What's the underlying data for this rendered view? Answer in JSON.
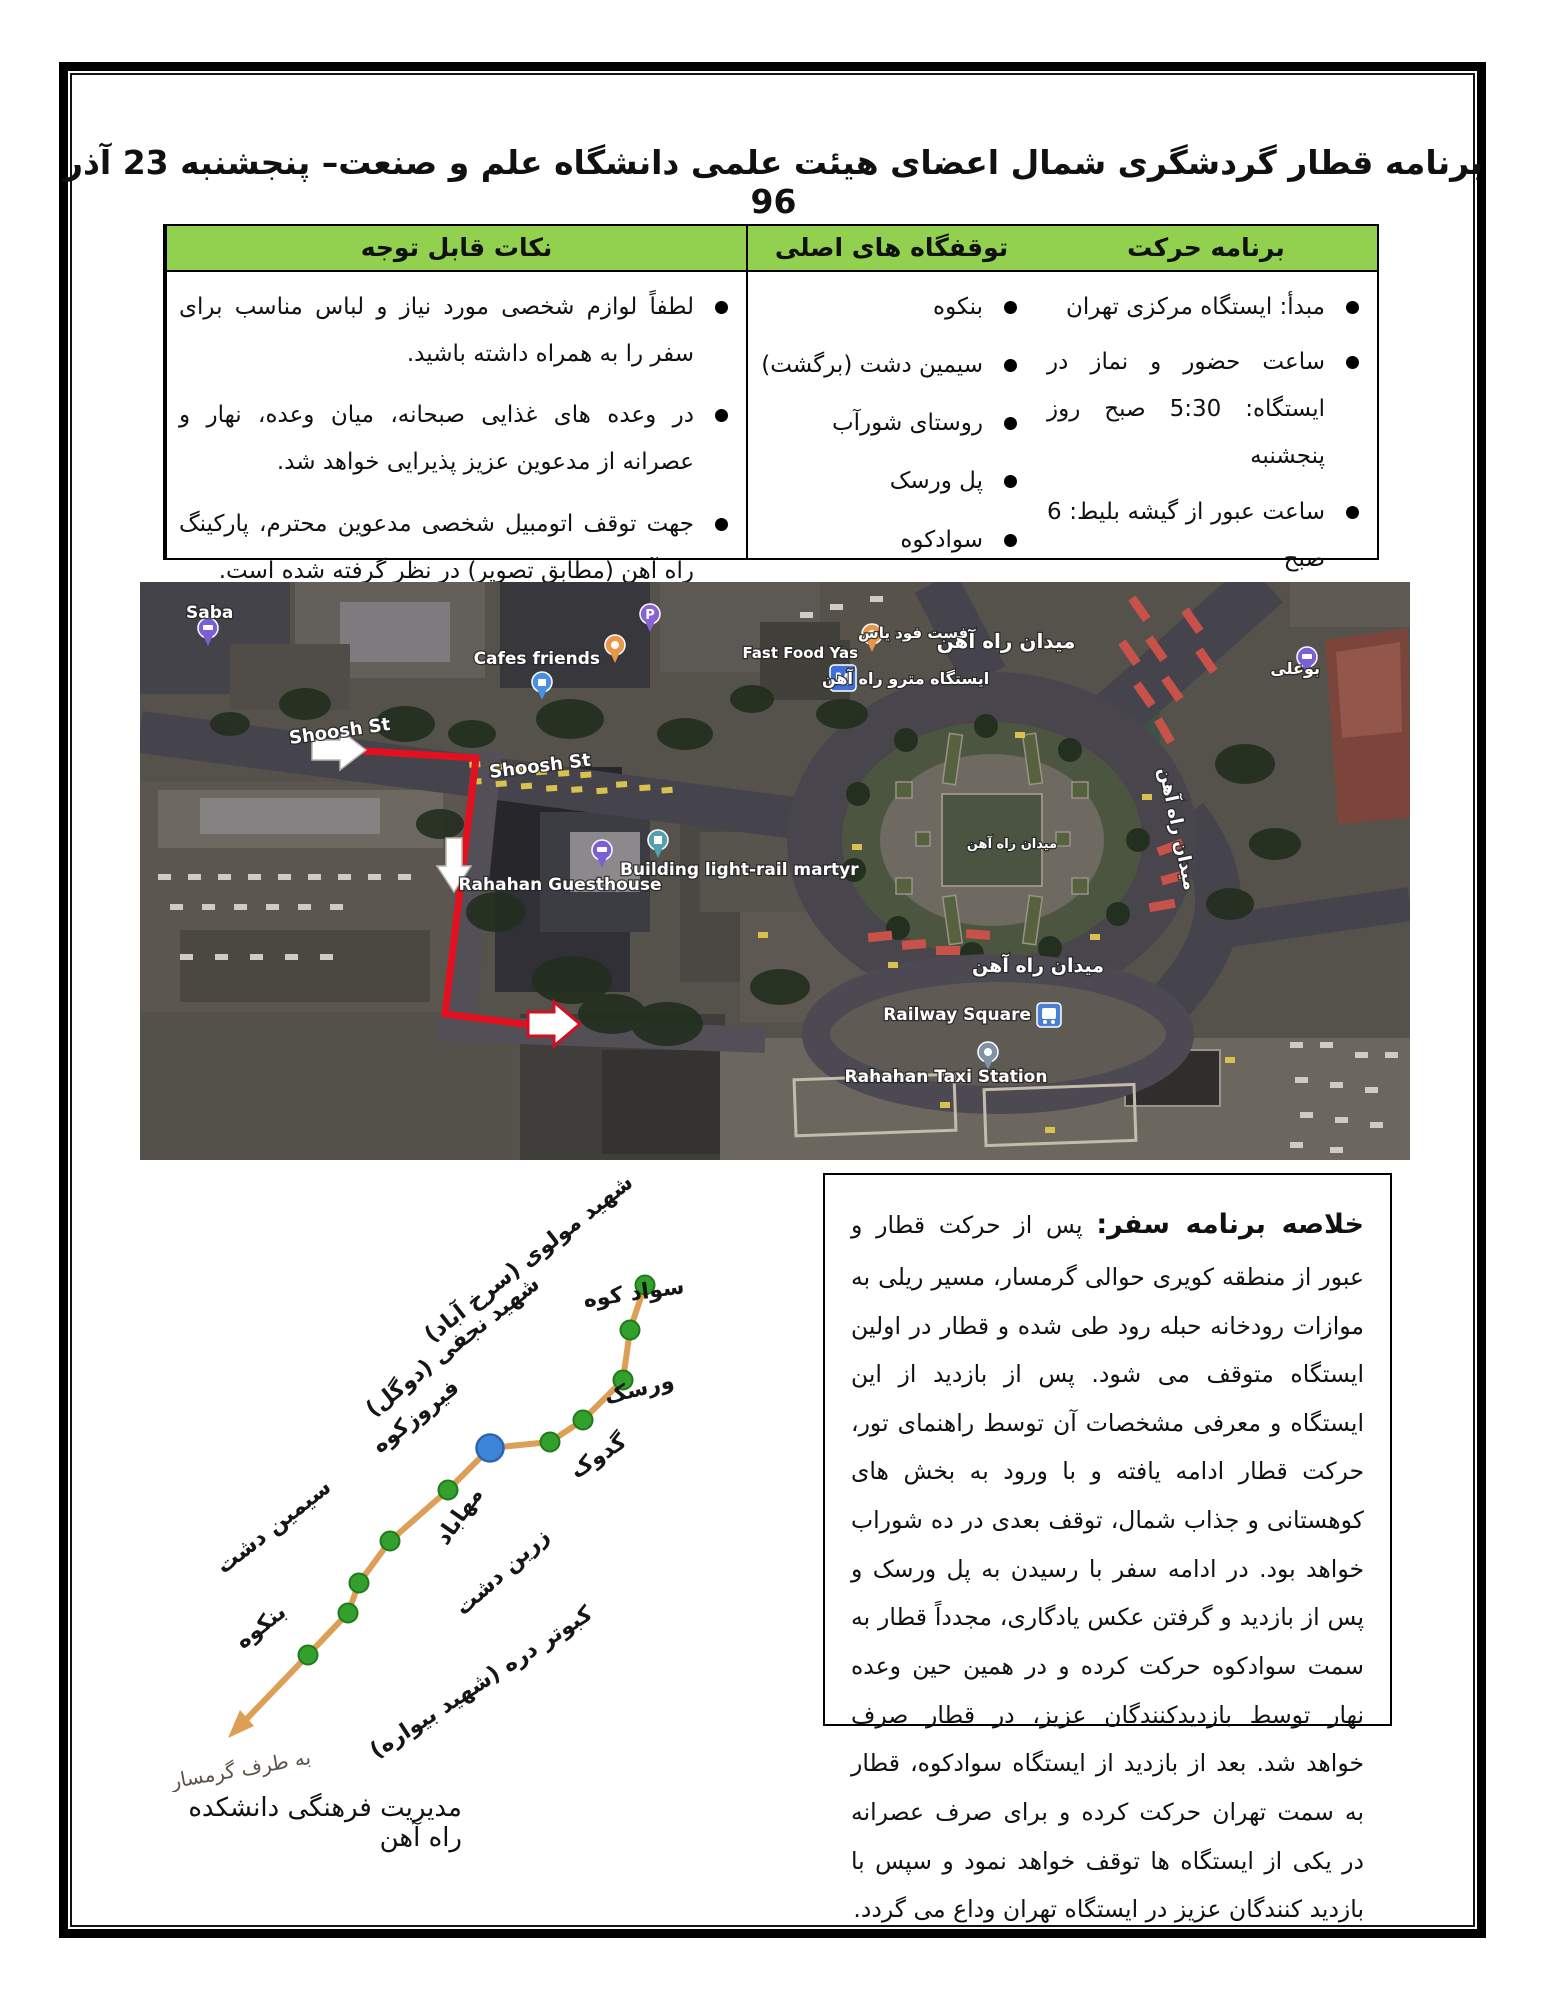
{
  "title": "برنامه قطار گردشگری شمال اعضای هیئت علمی دانشگاه علم و صنعت– پنجشنبه 23 آذر 96",
  "table": {
    "headers": {
      "schedule": "برنامه حرکت",
      "stops": "توقفگاه های اصلی",
      "notes": "نکات قابل توجه"
    },
    "schedule": [
      "مبدأ: ایستگاه مرکزی تهران",
      "ساعت حضور و نماز در ایستگاه: 5:30 صبح روز پنجشنبه",
      "ساعت عبور از گیشه بلیط: 6 صبح",
      "ساعت حرکت قطار: 6:30 صبح",
      "مدت زمان سفر: 16 ساعت"
    ],
    "stops": [
      "بنکوه",
      "سیمین دشت (برگشت)",
      "روستای شورآب",
      "پل ورسک",
      "سوادکوه"
    ],
    "notes": [
      "لطفاً لوازم شخصی مورد نیاز و لباس مناسب برای سفر را به همراه داشته باشید.",
      "در وعده های غذایی صبحانه، میان وعده، نهار و عصرانه از مدعوین عزیز پذیرایی خواهد شد.",
      "جهت توقف اتومبیل شخصی مدعوین محترم، پارکینگ راه آهن (مطابق تصویر) در نظر گرفته شده است."
    ]
  },
  "map": {
    "labels": {
      "saba": "Saba",
      "shoosh_st": "Shoosh St",
      "cafes_friends": "Cafes friends",
      "metro_station_fa": "ایستگاه مترو راه آهن",
      "fast_food_fa": "فست فود یاس",
      "fast_food_en": "Fast Food Yas",
      "railway_square_fa": "میدان راه آهن",
      "bouali_fa": "بوعلی",
      "building_lightrail_en": "Building light-rail martyr",
      "guesthouse_en": "Rahahan Guesthouse",
      "railway_square_en": "Railway Square",
      "taxi_station_en": "Rahahan Taxi Station",
      "p_glyph": "P",
      "m_glyph": "M"
    }
  },
  "diagram": {
    "stations": [
      "سواد کوه",
      "شهید مولوی (سرخ آباد)",
      "ورسک",
      "شهید نجفی (دوگل)",
      "گدوک",
      "فیروزکوه",
      "مهاباد",
      "زرین دشت",
      "سیمین دشت",
      "بنکوه",
      "کبوتر دره (شهید بیواره)"
    ],
    "toward": "به طرف گرمسار"
  },
  "summary": {
    "heading": "خلاصه برنامه سفر:",
    "body": "پس از حرکت قطار و عبور از منطقه کویری حوالی گرمسار، مسیر ریلی به موازات رودخانه حبله رود طی شده و قطار در اولین ایستگاه متوقف می شود. پس از بازدید از این ایستگاه و معرفی مشخصات آن توسط راهنمای تور، حرکت قطار ادامه یافته و با ورود به بخش های کوهستانی و جذاب شمال، توقف بعدی در ده شوراب خواهد بود. در ادامه سفر با رسیدن به پل ورسک و پس از بازدید و گرفتن عکس یادگاری، مجدداً قطار به سمت سوادکوه حرکت کرده و در همین حین وعده نهار توسط بازدیدکنندگان عزیز، در قطار صرف خواهد شد. بعد از بازدید از ایستگاه سوادکوه، قطار به سمت تهران حرکت کرده و برای صرف عصرانه در یکی از ایستگاه ها توقف خواهد نمود و سپس با بازدید کنندگان عزیز در ایستگاه تهران وداع می گردد."
  },
  "footer": "مدیریت فرهنگی دانشکده راه آهن",
  "colors": {
    "header_green": "#92D050",
    "route_red": "#E3111F",
    "rail_line": "#DD9F55",
    "station_green": "#33A02C",
    "station_blue": "#3D85D8",
    "map_label_white": "#FFFFFF"
  }
}
